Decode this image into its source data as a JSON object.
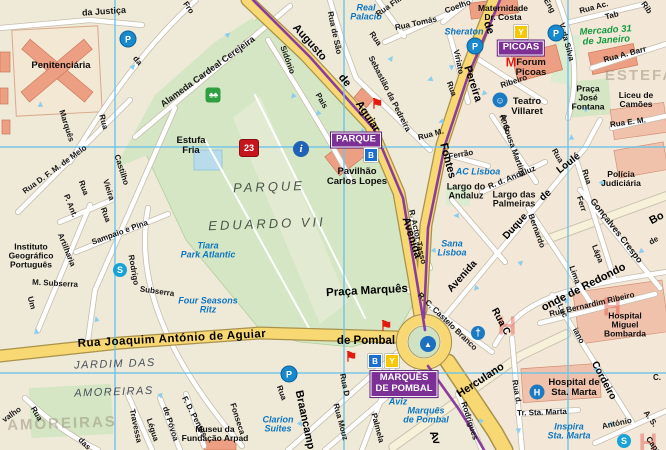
{
  "map": {
    "width": 666,
    "height": 450
  },
  "colors": {
    "road_yellow": "#f7d873",
    "metro_purple": "#8a3d9e",
    "hotel_blue": "#0d76c0",
    "market_green": "#169a3e",
    "sight_red": "#e21b10",
    "grid_blue": "#6ec3e8",
    "park_green": "#d4e6c4",
    "building_salmon": "#ec9f82",
    "metro_box_purple": "#7c2f95",
    "line_B_blue": "#1a6fd0",
    "line_Y_yellow": "#f5c800"
  },
  "metro_stations": [
    {
      "name": "PARQUE",
      "x": 356,
      "y": 140,
      "lines": [
        {
          "l": "B",
          "x": 371,
          "y": 155
        }
      ]
    },
    {
      "name": "PICOAS",
      "x": 521,
      "y": 48,
      "lines": [
        {
          "l": "Y",
          "x": 521,
          "y": 32
        }
      ]
    },
    {
      "name": "MARQUÊS\nDE POMBAL",
      "x": 404,
      "y": 384,
      "lines": [
        {
          "l": "B",
          "x": 375,
          "y": 361
        },
        {
          "l": "Y",
          "x": 392,
          "y": 361
        }
      ]
    }
  ],
  "labels": [
    {
      "t": "da Justiça",
      "x": 104,
      "y": 12,
      "r": -4,
      "c": "st9"
    },
    {
      "t": "Penitenciária",
      "x": 61,
      "y": 66,
      "r": 0,
      "c": "poiL"
    },
    {
      "t": "Fro",
      "x": 188,
      "y": 8,
      "r": 55,
      "c": "st"
    },
    {
      "t": "da",
      "x": 137,
      "y": 61,
      "r": 50,
      "c": "st"
    },
    {
      "t": "Rua",
      "x": 103,
      "y": 122,
      "r": 75,
      "c": "st"
    },
    {
      "t": "Marquês",
      "x": 66,
      "y": 126,
      "r": 72,
      "c": "st"
    },
    {
      "t": "Alameda Cardeal Cerejeira",
      "x": 208,
      "y": 72,
      "r": -36,
      "c": "st9"
    },
    {
      "t": "Real\nPalacio",
      "x": 366,
      "y": 13,
      "r": 0,
      "c": "hotel"
    },
    {
      "t": "Rua de São",
      "x": 334,
      "y": 33,
      "r": 78,
      "c": "st"
    },
    {
      "t": "Rua",
      "x": 375,
      "y": 39,
      "r": 55,
      "c": "st"
    },
    {
      "t": "Sebastião da Pedreira",
      "x": 389,
      "y": 94,
      "r": 63,
      "c": "st"
    },
    {
      "t": "Sidónio",
      "x": 287,
      "y": 60,
      "r": 70,
      "c": "st"
    },
    {
      "t": "Pais",
      "x": 321,
      "y": 101,
      "r": 60,
      "c": "st"
    },
    {
      "t": "Augusto",
      "x": 309,
      "y": 43,
      "r": 48,
      "c": "stM"
    },
    {
      "t": "de",
      "x": 344,
      "y": 81,
      "r": 50,
      "c": "stM"
    },
    {
      "t": "Aguiar",
      "x": 367,
      "y": 117,
      "r": 56,
      "c": "stM"
    },
    {
      "t": "Rua Fili",
      "x": 389,
      "y": 7,
      "r": -35,
      "c": "st"
    },
    {
      "t": "Rua Tomás",
      "x": 416,
      "y": 24,
      "r": -12,
      "c": "st"
    },
    {
      "t": "Coelho",
      "x": 458,
      "y": 7,
      "r": -20,
      "c": "st"
    },
    {
      "t": "Maternidade\nDr. Costa",
      "x": 503,
      "y": 13,
      "r": 0,
      "c": "poi"
    },
    {
      "t": "Sheraton",
      "x": 464,
      "y": 32,
      "r": 0,
      "c": "hotel"
    },
    {
      "t": "Viriato",
      "x": 458,
      "y": 62,
      "r": 78,
      "c": "st"
    },
    {
      "t": "Rua",
      "x": 451,
      "y": 89,
      "r": 70,
      "c": "st"
    },
    {
      "t": "de",
      "x": 488,
      "y": 28,
      "r": 70,
      "c": "stM"
    },
    {
      "t": "Pereira",
      "x": 472,
      "y": 84,
      "r": 72,
      "c": "stM"
    },
    {
      "t": "Fontes",
      "x": 447,
      "y": 161,
      "r": 75,
      "c": "stM"
    },
    {
      "t": "Avenida",
      "x": 411,
      "y": 238,
      "r": 72,
      "c": "stM"
    },
    {
      "t": "Eng",
      "x": 549,
      "y": 6,
      "r": 60,
      "c": "st"
    },
    {
      "t": "V. da Silva",
      "x": 566,
      "y": 42,
      "r": 75,
      "c": "st"
    },
    {
      "t": "Mercado 31\nde Janeiro",
      "x": 606,
      "y": 36,
      "r": -4,
      "c": "green"
    },
    {
      "t": "Rua Ac.",
      "x": 594,
      "y": 8,
      "r": -15,
      "c": "st"
    },
    {
      "t": "Tab",
      "x": 612,
      "y": 16,
      "r": -15,
      "c": "st"
    },
    {
      "t": "Rib",
      "x": 646,
      "y": 8,
      "r": 55,
      "c": "st"
    },
    {
      "t": "Rua A. Barr",
      "x": 625,
      "y": 55,
      "r": -15,
      "c": "st"
    },
    {
      "t": "ESTEFA",
      "x": 640,
      "y": 76,
      "r": 0,
      "c": "districtBig"
    },
    {
      "t": "Praça\nJosé\nFontana",
      "x": 588,
      "y": 98,
      "r": 0,
      "c": "poi"
    },
    {
      "t": "Liceu de\nCamões",
      "x": 636,
      "y": 100,
      "r": 0,
      "c": "poi"
    },
    {
      "t": "Rua E. M.",
      "x": 628,
      "y": 123,
      "r": -8,
      "c": "st"
    },
    {
      "t": "Forum\nPicoas",
      "x": 531,
      "y": 68,
      "r": 0,
      "c": "poiL"
    },
    {
      "t": "Ribeiro",
      "x": 514,
      "y": 82,
      "r": -18,
      "c": "st"
    },
    {
      "t": "Teatro\nVillaret",
      "x": 527,
      "y": 107,
      "r": 0,
      "c": "poiL"
    },
    {
      "t": "Andr.",
      "x": 505,
      "y": 124,
      "r": 75,
      "c": "st"
    },
    {
      "t": "Rua M.",
      "x": 431,
      "y": 135,
      "r": -15,
      "c": "st"
    },
    {
      "t": "Ferrão",
      "x": 461,
      "y": 155,
      "r": -10,
      "c": "st"
    },
    {
      "t": "R. Sousa Martins",
      "x": 512,
      "y": 146,
      "r": 70,
      "c": "st"
    },
    {
      "t": "AC Lisboa",
      "x": 478,
      "y": 172,
      "r": 0,
      "c": "hotel"
    },
    {
      "t": "Largo do\nAndaluz",
      "x": 466,
      "y": 192,
      "r": 0,
      "c": "st9"
    },
    {
      "t": "R. d. Andaluz",
      "x": 512,
      "y": 178,
      "r": -22,
      "c": "st"
    },
    {
      "t": "Largo das\nPalmeiras",
      "x": 514,
      "y": 200,
      "r": 0,
      "c": "st9"
    },
    {
      "t": "Loulé",
      "x": 569,
      "y": 164,
      "r": -38,
      "c": "stM10"
    },
    {
      "t": "de",
      "x": 546,
      "y": 196,
      "r": -40,
      "c": "stM10"
    },
    {
      "t": "Duque",
      "x": 516,
      "y": 227,
      "r": -48,
      "c": "stM10"
    },
    {
      "t": "Avenida",
      "x": 463,
      "y": 277,
      "r": -48,
      "c": "stM10"
    },
    {
      "t": "Rua",
      "x": 557,
      "y": 156,
      "r": 60,
      "c": "st"
    },
    {
      "t": "Rua",
      "x": 586,
      "y": 177,
      "r": 72,
      "c": "st"
    },
    {
      "t": "Ferr",
      "x": 581,
      "y": 204,
      "r": 72,
      "c": "st"
    },
    {
      "t": "Lápa",
      "x": 597,
      "y": 254,
      "r": 68,
      "c": "st"
    },
    {
      "t": "Bernardo",
      "x": 536,
      "y": 231,
      "r": 70,
      "c": "st"
    },
    {
      "t": "Lima",
      "x": 574,
      "y": 275,
      "r": 70,
      "c": "st"
    },
    {
      "t": "Gonçalves Crespo",
      "x": 616,
      "y": 231,
      "r": 52,
      "c": "st9"
    },
    {
      "t": "Polícia\nJudiciária",
      "x": 621,
      "y": 179,
      "r": 0,
      "c": "poi"
    },
    {
      "t": "Bo",
      "x": 657,
      "y": 219,
      "r": -28,
      "c": "stM"
    },
    {
      "t": "de",
      "x": 654,
      "y": 241,
      "r": -30,
      "c": "st"
    },
    {
      "t": "Rua C",
      "x": 500,
      "y": 322,
      "r": 62,
      "c": "stM10"
    },
    {
      "t": "onde de Redondo",
      "x": 584,
      "y": 288,
      "r": -27,
      "c": "stM"
    },
    {
      "t": "Rua Bernardim Ribeiro",
      "x": 592,
      "y": 305,
      "r": -13,
      "c": "st"
    },
    {
      "t": "Luc",
      "x": 562,
      "y": 311,
      "r": 65,
      "c": "st"
    },
    {
      "t": "iano",
      "x": 578,
      "y": 336,
      "r": 62,
      "c": "st"
    },
    {
      "t": "Cordeiro",
      "x": 603,
      "y": 381,
      "r": 62,
      "c": "stM10"
    },
    {
      "t": "Hospital\nMiguel\nBombarda",
      "x": 625,
      "y": 325,
      "r": 0,
      "c": "poi"
    },
    {
      "t": "R. Actor Tasso",
      "x": 417,
      "y": 237,
      "r": 77,
      "c": "st"
    },
    {
      "t": "Sana\nLisboa",
      "x": 452,
      "y": 249,
      "r": 0,
      "c": "hotel"
    },
    {
      "t": "R. C. Castelo Branco",
      "x": 447,
      "y": 322,
      "r": 44,
      "c": "st"
    },
    {
      "t": "Herculano",
      "x": 481,
      "y": 381,
      "r": -33,
      "c": "stM"
    },
    {
      "t": "Rodrigues",
      "x": 469,
      "y": 421,
      "r": 72,
      "c": "st"
    },
    {
      "t": "Rua d.",
      "x": 516,
      "y": 392,
      "r": 80,
      "c": "st"
    },
    {
      "t": "Tr. Sta. Marta",
      "x": 542,
      "y": 413,
      "r": -2,
      "c": "st"
    },
    {
      "t": "Hospital de\nSta. Marta",
      "x": 574,
      "y": 388,
      "r": 0,
      "c": "poiL"
    },
    {
      "t": "Inspira\nSta. Marta",
      "x": 569,
      "y": 432,
      "r": 0,
      "c": "hotel"
    },
    {
      "t": "António",
      "x": 617,
      "y": 424,
      "r": -12,
      "c": "st"
    },
    {
      "t": "A. S.",
      "x": 650,
      "y": 419,
      "r": 55,
      "c": "st"
    },
    {
      "t": "Capu",
      "x": 653,
      "y": 446,
      "r": 55,
      "c": "st"
    },
    {
      "t": "C.",
      "x": 657,
      "y": 378,
      "r": 0,
      "c": "st"
    },
    {
      "t": "Praça Marquês",
      "x": 367,
      "y": 291,
      "r": -3,
      "c": "poiXL"
    },
    {
      "t": "de Pombal",
      "x": 366,
      "y": 341,
      "r": 0,
      "c": "poiXL"
    },
    {
      "t": "Aviz",
      "x": 398,
      "y": 402,
      "r": 0,
      "c": "hotel"
    },
    {
      "t": "Marquês\nde Pombal",
      "x": 426,
      "y": 416,
      "r": 0,
      "c": "hotel"
    },
    {
      "t": "Av",
      "x": 434,
      "y": 438,
      "r": 70,
      "c": "stM"
    },
    {
      "t": "Rua D",
      "x": 344,
      "y": 385,
      "r": 78,
      "c": "st"
    },
    {
      "t": "Palmela",
      "x": 377,
      "y": 428,
      "r": 75,
      "c": "st"
    },
    {
      "t": "Rua Mouz",
      "x": 340,
      "y": 422,
      "r": 75,
      "c": "st"
    },
    {
      "t": "Braancamp",
      "x": 304,
      "y": 420,
      "r": 78,
      "c": "stM"
    },
    {
      "t": "Rua",
      "x": 281,
      "y": 393,
      "r": 70,
      "c": "st"
    },
    {
      "t": "Clarion\nSuites",
      "x": 278,
      "y": 425,
      "r": 0,
      "c": "hotel"
    },
    {
      "t": "Fonseca",
      "x": 237,
      "y": 419,
      "r": 72,
      "c": "st"
    },
    {
      "t": "Rua Joaquim António de Aguiar",
      "x": 172,
      "y": 339,
      "r": -3,
      "c": "stXL"
    },
    {
      "t": "JARDIM DAS",
      "x": 115,
      "y": 365,
      "r": -2,
      "c": "district"
    },
    {
      "t": "AMOREIRAS",
      "x": 114,
      "y": 393,
      "r": -2,
      "c": "district"
    },
    {
      "t": "AMOREIRAS",
      "x": 62,
      "y": 424,
      "r": -2,
      "c": "districtBig"
    },
    {
      "t": "valho",
      "x": 12,
      "y": 415,
      "r": -35,
      "c": "st"
    },
    {
      "t": "Rua",
      "x": 36,
      "y": 414,
      "r": 60,
      "c": "st"
    },
    {
      "t": "das",
      "x": 84,
      "y": 444,
      "r": 45,
      "c": "st"
    },
    {
      "t": "Travessa",
      "x": 135,
      "y": 426,
      "r": 78,
      "c": "st"
    },
    {
      "t": "Légua",
      "x": 152,
      "y": 430,
      "r": 72,
      "c": "st"
    },
    {
      "t": "de Póvoa",
      "x": 170,
      "y": 424,
      "r": 72,
      "c": "st"
    },
    {
      "t": "F. D. Pentes",
      "x": 194,
      "y": 417,
      "r": 62,
      "c": "st"
    },
    {
      "t": "Museu da\nFundação Arpad",
      "x": 215,
      "y": 434,
      "r": 0,
      "c": "poi"
    },
    {
      "t": "M. Subserra",
      "x": 55,
      "y": 284,
      "r": 3,
      "c": "st"
    },
    {
      "t": "Subserra",
      "x": 157,
      "y": 292,
      "r": 8,
      "c": "st"
    },
    {
      "t": "Rua",
      "x": 105,
      "y": 215,
      "r": 70,
      "c": "st"
    },
    {
      "t": "Sampaio e Pina",
      "x": 120,
      "y": 233,
      "r": -20,
      "c": "st"
    },
    {
      "t": "Artilharia",
      "x": 66,
      "y": 250,
      "r": 68,
      "c": "st"
    },
    {
      "t": "Um",
      "x": 31,
      "y": 303,
      "r": 75,
      "c": "st"
    },
    {
      "t": "Rodrigo",
      "x": 133,
      "y": 270,
      "r": 80,
      "c": "st"
    },
    {
      "t": "Castilho",
      "x": 121,
      "y": 170,
      "r": 72,
      "c": "st"
    },
    {
      "t": "Vieira",
      "x": 108,
      "y": 190,
      "r": 72,
      "c": "st"
    },
    {
      "t": "P. Ant.",
      "x": 70,
      "y": 206,
      "r": 68,
      "c": "st"
    },
    {
      "t": "Rua",
      "x": 83,
      "y": 188,
      "r": 70,
      "c": "st"
    },
    {
      "t": "Rua D. F. M. de Melo",
      "x": 55,
      "y": 170,
      "r": -36,
      "c": "st"
    },
    {
      "t": "Instituto\nGeográfico\nPortuguês",
      "x": 31,
      "y": 256,
      "r": 0,
      "c": "poi"
    },
    {
      "t": "Tiara\nPark Atlantic",
      "x": 208,
      "y": 251,
      "r": 0,
      "c": "hotel"
    },
    {
      "t": "Four Seasons\nRitz",
      "x": 208,
      "y": 306,
      "r": 0,
      "c": "hotel"
    },
    {
      "t": "Estufa\nFria",
      "x": 191,
      "y": 146,
      "r": 0,
      "c": "poiL"
    },
    {
      "t": "PARQUE",
      "x": 269,
      "y": 187,
      "r": -2,
      "c": "parkName"
    },
    {
      "t": "EDUARDO VII",
      "x": 267,
      "y": 224,
      "r": -2,
      "c": "parkName"
    },
    {
      "t": "Pavilhão\nCarlos Lopes",
      "x": 357,
      "y": 177,
      "r": 0,
      "c": "poiL"
    }
  ],
  "icons": [
    {
      "k": "parking",
      "t": "P",
      "x": 128,
      "y": 39
    },
    {
      "k": "parking",
      "t": "P",
      "x": 475,
      "y": 46
    },
    {
      "k": "parking",
      "t": "P",
      "x": 556,
      "y": 33
    },
    {
      "k": "parking",
      "t": "P",
      "x": 289,
      "y": 374
    },
    {
      "k": "metroM",
      "t": "M",
      "x": 511,
      "y": 62
    },
    {
      "k": "flag",
      "t": "⚑",
      "x": 377,
      "y": 104
    },
    {
      "k": "flag",
      "t": "⚑",
      "x": 386,
      "y": 326
    },
    {
      "k": "flag",
      "t": "⚑",
      "x": 351,
      "y": 357
    },
    {
      "k": "shield",
      "t": "23",
      "x": 249,
      "y": 148
    },
    {
      "k": "info",
      "t": "i",
      "x": 301,
      "y": 149
    },
    {
      "k": "tree",
      "t": "♣♣",
      "x": 213,
      "y": 95
    },
    {
      "k": "sbadge",
      "t": "S",
      "x": 120,
      "y": 270
    },
    {
      "k": "sbadge",
      "t": "S",
      "x": 624,
      "y": 441
    },
    {
      "k": "theatre",
      "t": "☺",
      "x": 500,
      "y": 100
    },
    {
      "k": "monument",
      "t": "▲",
      "x": 428,
      "y": 344
    },
    {
      "k": "church",
      "t": "†",
      "x": 478,
      "y": 333
    },
    {
      "k": "hospital",
      "t": "H",
      "x": 537,
      "y": 392
    },
    {
      "k": "hmark",
      "t": "H",
      "x": 507,
      "y": 326
    },
    {
      "k": "hmark",
      "t": "H",
      "x": 612,
      "y": 307
    },
    {
      "k": "hmark",
      "t": "H",
      "x": 648,
      "y": 443
    },
    {
      "k": "arrow",
      "t": "►",
      "x": 133,
      "y": 66,
      "r": -45
    },
    {
      "k": "arrow",
      "t": "►",
      "x": 40,
      "y": 104,
      "r": -90
    },
    {
      "k": "arrow",
      "t": "►",
      "x": 228,
      "y": 34,
      "r": -40
    },
    {
      "k": "arrow",
      "t": "►",
      "x": 293,
      "y": 97,
      "r": 130
    },
    {
      "k": "arrow",
      "t": "►",
      "x": 318,
      "y": 114,
      "r": 135
    },
    {
      "k": "arrow",
      "t": "►",
      "x": 362,
      "y": 132,
      "r": 140
    },
    {
      "k": "arrow",
      "t": "►",
      "x": 391,
      "y": 58,
      "r": -55
    },
    {
      "k": "arrow",
      "t": "►",
      "x": 452,
      "y": 68,
      "r": 90
    },
    {
      "k": "arrow",
      "t": "►",
      "x": 484,
      "y": 94,
      "r": 135
    },
    {
      "k": "arrow",
      "t": "►",
      "x": 441,
      "y": 122,
      "r": 165
    },
    {
      "k": "arrow",
      "t": "►",
      "x": 456,
      "y": 216,
      "r": 180
    },
    {
      "k": "arrow",
      "t": "►",
      "x": 521,
      "y": 262,
      "r": -40
    },
    {
      "k": "arrow",
      "t": "►",
      "x": 476,
      "y": 289,
      "r": 130
    },
    {
      "k": "arrow",
      "t": "►",
      "x": 567,
      "y": 300,
      "r": -15
    },
    {
      "k": "arrow",
      "t": "►",
      "x": 597,
      "y": 370,
      "r": 55
    },
    {
      "k": "arrow",
      "t": "►",
      "x": 612,
      "y": 424,
      "r": 35
    },
    {
      "k": "arrow",
      "t": "►",
      "x": 481,
      "y": 422,
      "r": 115
    },
    {
      "k": "arrow",
      "t": "►",
      "x": 301,
      "y": 424,
      "r": 55
    },
    {
      "k": "arrow",
      "t": "►",
      "x": 161,
      "y": 396,
      "r": 75
    },
    {
      "k": "arrow",
      "t": "►",
      "x": 36,
      "y": 331,
      "r": -90
    },
    {
      "k": "arrow",
      "t": "►",
      "x": 96,
      "y": 319,
      "r": -105
    },
    {
      "k": "arrow",
      "t": "►",
      "x": 601,
      "y": 183,
      "r": 180
    },
    {
      "k": "arrow",
      "t": "►",
      "x": 641,
      "y": 252,
      "r": 140
    },
    {
      "k": "arrow",
      "t": "►",
      "x": 519,
      "y": 431,
      "r": 85
    },
    {
      "k": "arrow",
      "t": "►",
      "x": 433,
      "y": 251,
      "r": 170
    },
    {
      "k": "arrow",
      "t": "►",
      "x": 586,
      "y": 110,
      "r": 85
    },
    {
      "k": "arrow",
      "t": "►",
      "x": 571,
      "y": 137,
      "r": -95
    },
    {
      "k": "arrow",
      "t": "►",
      "x": 430,
      "y": 80,
      "r": 160
    }
  ]
}
